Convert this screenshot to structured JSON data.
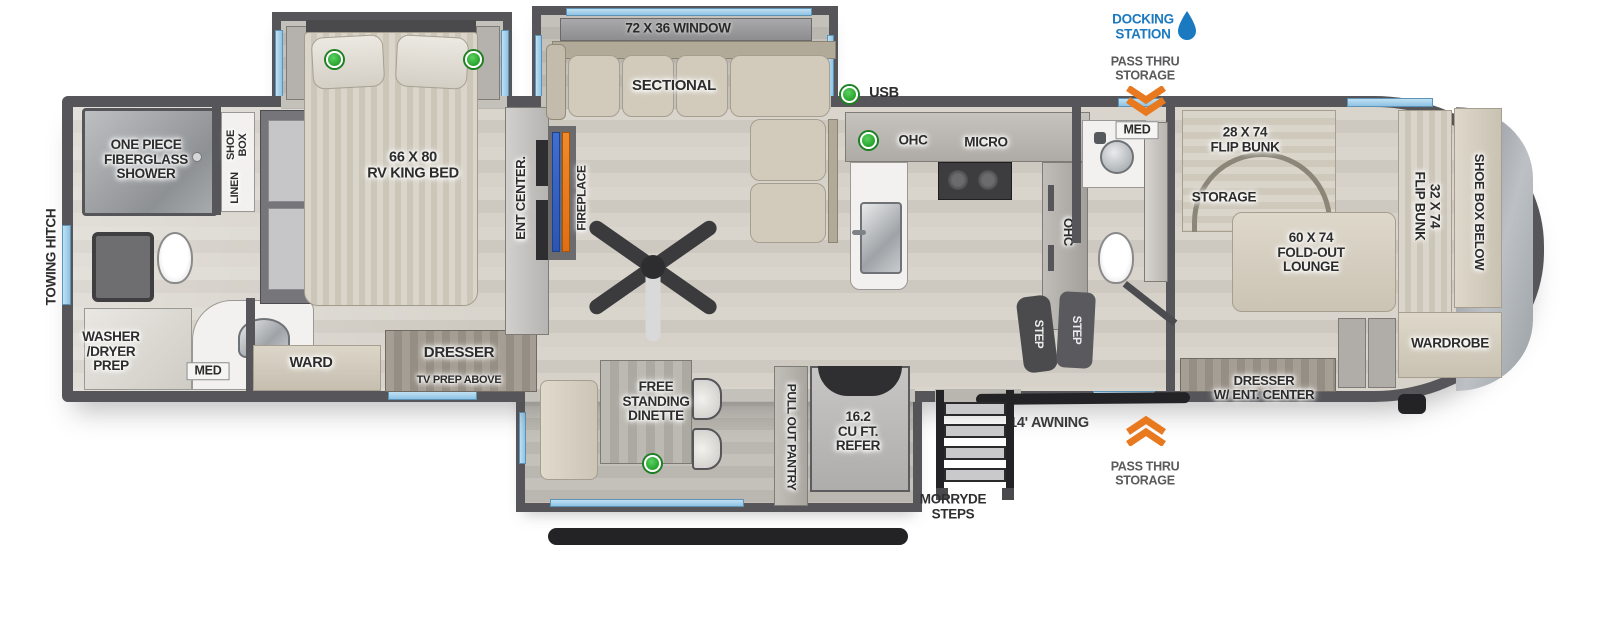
{
  "title": "RV fifth wheel floorplan",
  "colors": {
    "wall": "#56565a",
    "accent_blue": "#1b79c0",
    "accent_orange": "#e8791e",
    "window_blue": "#9fcde9",
    "indicator_green": "#27a32d",
    "furniture_beige": "#d7d1c3"
  },
  "callouts": {
    "docking_station": "DOCKING\nSTATION",
    "pass_thru_top": "PASS THRU\nSTORAGE",
    "pass_thru_bottom": "PASS THRU\nSTORAGE",
    "awning": "14' AWNING",
    "morryde_steps": "MORRYDE\nSTEPS",
    "towing_hitch": "TOWING HITCH",
    "usb": "USB"
  },
  "labels": {
    "window_72": "72 X 36 WINDOW",
    "sectional": "SECTIONAL",
    "fireplace": "FIREPLACE",
    "ent_center": "ENT CENTER.",
    "king_bed": "66 X 80\nRV KING BED",
    "shoe_box": "SHOE\nBOX",
    "linen": "LINEN",
    "shower": "ONE PIECE\nFIBERGLASS\nSHOWER",
    "washer_dryer": "WASHER\n/DRYER\nPREP",
    "med_rear": "MED",
    "ward": "WARD",
    "dresser_tv1": "DRESSER",
    "dresser_tv2": "TV PREP ABOVE",
    "free_standing_dinette": "FREE\nSTANDING\nDINETTE",
    "pull_out_pantry": "PULL OUT PANTRY",
    "refer": "16.2\nCU FT.\nREFER",
    "ohc_top": "OHC",
    "micro": "MICRO",
    "ohc_side": "OHC",
    "step1": "STEP",
    "step2": "STEP",
    "med_mid": "MED",
    "flip_bunk_28": "28 X 74\nFLIP BUNK",
    "storage": "STORAGE",
    "fold_out_lounge": "60 X 74\nFOLD-OUT\nLOUNGE",
    "flip_bunk_32": "32 X 74\nFLIP BUNK",
    "shoe_box_below": "SHOE BOX BELOW",
    "wardrobe": "WARDROBE",
    "dresser_ent": "DRESSER\nW/ ENT. CENTER"
  }
}
